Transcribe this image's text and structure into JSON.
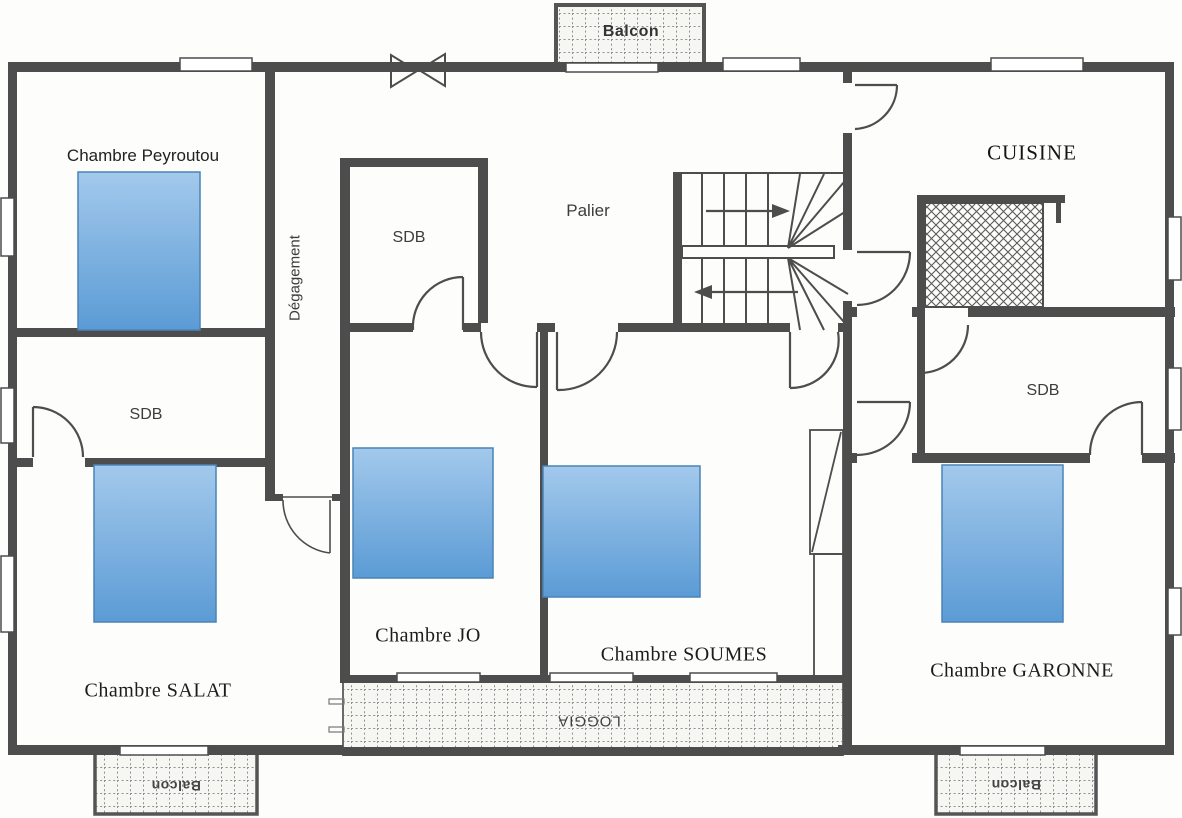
{
  "plan": {
    "rooms": {
      "peyroutou": "Chambre Peyroutou",
      "salat": "Chambre SALAT",
      "jo": "Chambre JO",
      "soumes": "Chambre SOUMES",
      "garonne": "Chambre GARONNE",
      "cuisine": "CUISINE",
      "palier": "Palier",
      "degagement": "Dégagement",
      "sdb_center": "SDB",
      "sdb_left": "SDB",
      "sdb_right": "SDB"
    },
    "outdoor": {
      "balcon_top": "Balcon",
      "balcon_bottom_left": "Balcon",
      "balcon_bottom_right": "Balcon",
      "loggia": "LOGGIA"
    },
    "colors": {
      "wall": "#4d4d4d",
      "bed_fill_top": "#9fc5e8",
      "bed_fill_bottom": "#5b9bd5",
      "bed_border": "#4a84b8"
    }
  }
}
